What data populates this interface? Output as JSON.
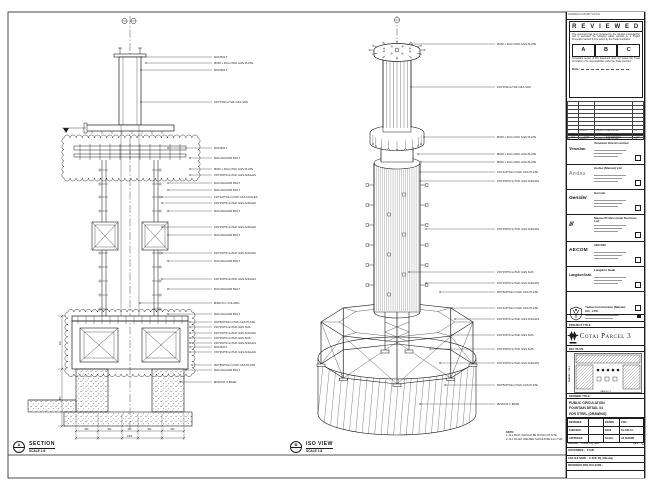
{
  "colors": {
    "line": "#1c1c1c",
    "paper": "#ffffff"
  },
  "section_view": {
    "marker": "A",
    "title": "SECTION",
    "scale": "SCALE 1:8",
    "labels": [
      {
        "y": 57,
        "x0": 141,
        "text": "M20 BOLT"
      },
      {
        "y": 63,
        "x0": 146,
        "text": "Ø340 x 20mmTHK G&S PLATE"
      },
      {
        "y": 70,
        "x0": 141,
        "text": "M20 BOLT"
      },
      {
        "y": 102,
        "x0": 141,
        "text": "150*150mmTHK G&S SHS"
      },
      {
        "y": 148,
        "x0": 168,
        "text": "M20 BOLT"
      },
      {
        "y": 158,
        "x0": 190,
        "text": "M20 ANCHOR BOLT"
      },
      {
        "y": 169,
        "x0": 190,
        "text": "Ø340 x 20mmTHK G&S PLATE"
      },
      {
        "y": 175,
        "x0": 190,
        "text": "150*150*6mmTHK G&S ANGLES"
      },
      {
        "y": 183,
        "x0": 168,
        "text": "M20 ANCHOR BOLT"
      },
      {
        "y": 190,
        "x0": 168,
        "text": "M20 ANCHOR BOLT"
      },
      {
        "y": 197,
        "x0": 162,
        "text": "120*120*10mmTHK G&S ANGLES"
      },
      {
        "y": 203,
        "x0": 162,
        "text": "150*150*6mmTHK G&S ANGLES"
      },
      {
        "y": 211,
        "x0": 168,
        "text": "M20 ANCHOR BOLT"
      },
      {
        "y": 227,
        "x0": 162,
        "text": "150*150*6mmTHK G&S ANGLES"
      },
      {
        "y": 235,
        "x0": 168,
        "text": "M20 ANCHOR BOLT"
      },
      {
        "y": 253,
        "x0": 162,
        "text": "150*150*6mmTHK G&S ANGLES"
      },
      {
        "y": 261,
        "x0": 168,
        "text": "M20 ANCHOR BOLT"
      },
      {
        "y": 279,
        "x0": 162,
        "text": "150*150*6mmTHK G&S ANGLES"
      },
      {
        "y": 289,
        "x0": 168,
        "text": "M20 ANCHOR BOLT"
      },
      {
        "y": 303,
        "x0": 140,
        "text": "Ø300 R.C COLUMN"
      },
      {
        "y": 314,
        "x0": 168,
        "text": "M20 ANCHOR BOLT"
      },
      {
        "y": 322,
        "x0": 190,
        "text": "600*600*20mmTHK G&S PLATE"
      },
      {
        "y": 327,
        "x0": 190,
        "text": "150*150*6mmTHK G&S SHS"
      },
      {
        "y": 333,
        "x0": 190,
        "text": "150*150*6mmTHK G&S ANGLES"
      },
      {
        "y": 338,
        "x0": 190,
        "text": "150*150*6mmTHK G&S SHS"
      },
      {
        "y": 343,
        "x0": 190,
        "text": "150*150*6mmTHK G&S ANGLES"
      },
      {
        "y": 347,
        "x0": 190,
        "text": "M20 BOLT"
      },
      {
        "y": 352,
        "x0": 190,
        "text": "150*150*6mmTHK G&S ANGLES"
      },
      {
        "y": 365,
        "x0": 192,
        "text": "500*500*20mmTHK G&S PLATE"
      },
      {
        "y": 370,
        "x0": 186,
        "text": "M20 ANCHOR BOLT"
      },
      {
        "y": 382,
        "x0": 180,
        "text": "Ø2000 R.C BASE"
      }
    ],
    "dims_bottom": {
      "labels": [
        "600",
        "300",
        "450",
        "300",
        "600"
      ],
      "total": "2400"
    },
    "dims_left": [
      "600",
      "450"
    ]
  },
  "iso_view": {
    "marker": "B",
    "title": "ISO VIEW",
    "scale": "SCALE 1:8",
    "labels": [
      {
        "y": 44,
        "x0": 412,
        "text": "Ø340 x 20mmTHK G&S PLATE"
      },
      {
        "y": 87,
        "x0": 411,
        "text": "150*150mmTHK G&S SHS"
      },
      {
        "y": 137,
        "x0": 424,
        "text": "Ø340 x 20mmTHK G&S PLATE"
      },
      {
        "y": 154,
        "x0": 418,
        "text": "Ø300 x 20mmTHK G&S PLATE"
      },
      {
        "y": 162,
        "x0": 421,
        "text": "Ø340 x 20mmTHK G&S PLATE"
      },
      {
        "y": 172,
        "x0": 420,
        "text": "120*120*10mmTHK G&S PLATE"
      },
      {
        "y": 181,
        "x0": 420,
        "text": "150*150*6mmTHK G&S ANGLES"
      },
      {
        "y": 229,
        "x0": 426,
        "text": "150*150*6mmTHK G&S ANGLES"
      },
      {
        "y": 272,
        "x0": 409,
        "text": "150*150*6mmTHK G&S SHS"
      },
      {
        "y": 283,
        "x0": 426,
        "text": "150*150*6mmTHK G&S ANGLES"
      },
      {
        "y": 292,
        "x0": 440,
        "text": "600*600*20mmTHK G&S PLATE"
      },
      {
        "y": 308,
        "x0": 452,
        "text": "120*120*10mmTHK G&S PLATE"
      },
      {
        "y": 319,
        "x0": 455,
        "text": "150*150*6mmTHK G&S ANGLES"
      },
      {
        "y": 335,
        "x0": 452,
        "text": "150*150*6mmTHK G&S SHS"
      },
      {
        "y": 349,
        "x0": 430,
        "text": "150*150*6mmTHK G&S SHS"
      },
      {
        "y": 363,
        "x0": 440,
        "text": "150*150*6mmTHK G&S ANGLES"
      },
      {
        "y": 385,
        "x0": 445,
        "text": "500*500*20mmTHK G&S PLATE"
      },
      {
        "y": 404,
        "x0": 420,
        "text": "Ø2000 R.C BASE"
      }
    ]
  },
  "notes": {
    "heading": "NOTE:",
    "items": [
      "1. ALL BOLT SHOULD BE FIXING ON SITE.",
      "2. ALL FILLET WELDED SHOULD BE 6mm THK."
    ]
  },
  "title_block": {
    "stamp_line": "04/06/2013 14:05  9977  A4  P.01",
    "reviewed_stamp": {
      "title": "REVIEWED",
      "body_top": "This document has been reviewed by the relevant Consultant(s) and is accorded the following status relevant to a Project Procedure Section 5.4 for action by the Trade Contractor.",
      "options": [
        "A",
        "B",
        "C"
      ],
      "body_bottom": "Consultant review of this document does not relieve the Trade Contractor of its responsibilities under the Trade Contract.",
      "date_label": "Date :"
    },
    "revisions": {
      "headers": [
        "REV",
        "DATE",
        "DESCRIPTION",
        "BY"
      ],
      "empty_rows": 7,
      "rows": [
        [
          "C",
          "04-06-13",
          "ISSUED FOR APPROVAL",
          "CW"
        ],
        [
          "B",
          "28-05-13",
          "ISSUED FOR APPROVAL",
          "CW"
        ],
        [
          "A",
          "14-05-13",
          "ISSUED FOR APPROVAL",
          "CW"
        ]
      ]
    },
    "companies": [
      {
        "logo": "Venetian",
        "name": "Venetian Orient Limited"
      },
      {
        "logo": "Aedas",
        "name": "Aedas (Macau) Ltd."
      },
      {
        "logo": "Gensler",
        "name": "Gensler"
      },
      {
        "logo": "///",
        "name": "Macau Professional Services Ltd."
      },
      {
        "logo": "AECOM",
        "name": "AECOM"
      },
      {
        "logo": "LangdonSeah",
        "name": "Langdon Seah"
      },
      {
        "logo": "",
        "name": ""
      }
    ],
    "contractor": {
      "name": "Yadea Construction (Macau) CO., LTD."
    },
    "project_title_label": "PROJECT TITLE",
    "project_title": "Cotai Parcel 3",
    "key_plan_label": "KEY PLAN",
    "key_plan_side": "PARCEL 1 OF 3",
    "key_plan_caption": "PARCEL 3",
    "drawing_title_label": "DRAWING TITLE:",
    "drawing_title_lines": [
      "PUBLIC CIRCULATION",
      "FOUNTAIN DETAIL 04",
      "FOR STEEL (DRAWING)"
    ],
    "approval_rows": [
      {
        "label": "DESIGNED",
        "value": "-",
        "label2": "DRAWN",
        "value2": "CWC"
      },
      {
        "label": "CHECKED",
        "value": "-",
        "label2": "DATE",
        "value2": "04-JUN-13"
      },
      {
        "label": "APPROVED",
        "value": "-",
        "label2": "SCALE",
        "value2": "AS SHOWN"
      }
    ],
    "doc_rows": [
      {
        "label": "DWG NO :",
        "value": "P-SUB_PQ_0001",
        "extra_label": "REV :",
        "extra": "C"
      },
      {
        "label": "JOB NUMBER :",
        "value": "P-SUB",
        "extra_label": "",
        "extra": ""
      },
      {
        "label": "CAD FILE NAME :",
        "value": "P-SUB_PQ_0001.dwg",
        "extra_label": "",
        "extra": ""
      },
      {
        "label": "REFERENCE DWG FILE NAME :",
        "value": "",
        "extra_label": "",
        "extra": ""
      }
    ]
  }
}
